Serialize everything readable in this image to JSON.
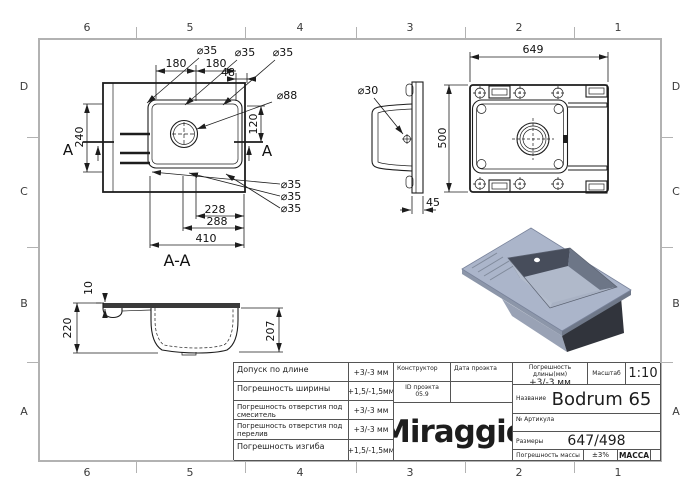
{
  "sheet": {
    "background": "#ffffff",
    "frame_color": "#b2b2b2",
    "line_color": "#1d1d1d"
  },
  "grid": {
    "cols": [
      "6",
      "5",
      "4",
      "3",
      "2",
      "1"
    ],
    "rows": [
      "D",
      "C",
      "B",
      "A"
    ]
  },
  "top_view": {
    "hole_top": [
      "⌀35",
      "⌀35",
      "⌀35"
    ],
    "dim_180_left": "180",
    "dim_180_right": "180",
    "dim_48": "48",
    "dim_faucet": "⌀88",
    "dim_240": "240",
    "dim_120": "120",
    "hole_bottom": [
      "⌀35",
      "⌀35",
      "⌀35"
    ],
    "dim_228": "228",
    "dim_288": "288",
    "dim_410": "410",
    "section_letter_left": "A",
    "section_letter_right": "A",
    "section_title": "A-A"
  },
  "side_view": {
    "dim_overflow": "⌀30",
    "dim_depth": "45"
  },
  "back_view": {
    "dim_width": "649",
    "dim_height": "500"
  },
  "section_view": {
    "dim_rim": "10",
    "dim_total": "220",
    "dim_bowl": "207"
  },
  "render": {
    "colors": {
      "deck": "#abb5ca",
      "deck_edge_left": "#8c96a9",
      "deck_edge_right": "#6f7889",
      "wall_back": "#474d5b",
      "wall_right": "#6d7687",
      "wall_front_right": "#a9b2c4",
      "wall_front_left": "#b4bdcd",
      "floor": "#b0b9ca",
      "box_left": "#99a2b5",
      "box_right": "#31343c",
      "groove": "#808a9b",
      "hole": "#ffffff"
    }
  },
  "title_block": {
    "tolerances": [
      {
        "label": "Допуск по длине",
        "value": "+3/-3 мм"
      },
      {
        "label": "Погрешность ширины",
        "value": "+1,5/-1,5мм"
      },
      {
        "label": "Погрешность отверстия под смеситель",
        "value": "+3/-3 мм"
      },
      {
        "label": "Погрешность отверстия под перелив",
        "value": "+3/-3 мм"
      },
      {
        "label": "Погрешность изгиба",
        "value": "+1,5/-1,5мм"
      }
    ],
    "designer_label": "Конструктор",
    "project_date_label": "Дата проэкта",
    "project_id_label": "ID проэкта",
    "project_id_value": "05.9",
    "brand": "Miraggio",
    "length_tolerance_label": "Погрешность длины(мм)",
    "length_tolerance_value": "+3/-3 мм",
    "scale_label": "Масштаб",
    "scale_value": "1:10",
    "name_label": "Название",
    "name_value": "Bodrum 65",
    "article_label": "№ Артикула",
    "size_label": "Размеры",
    "size_value": "647/498",
    "mass_tolerance_label": "Погрешность массы",
    "mass_tolerance_value": "±3%",
    "mass_label": "МАССА"
  }
}
